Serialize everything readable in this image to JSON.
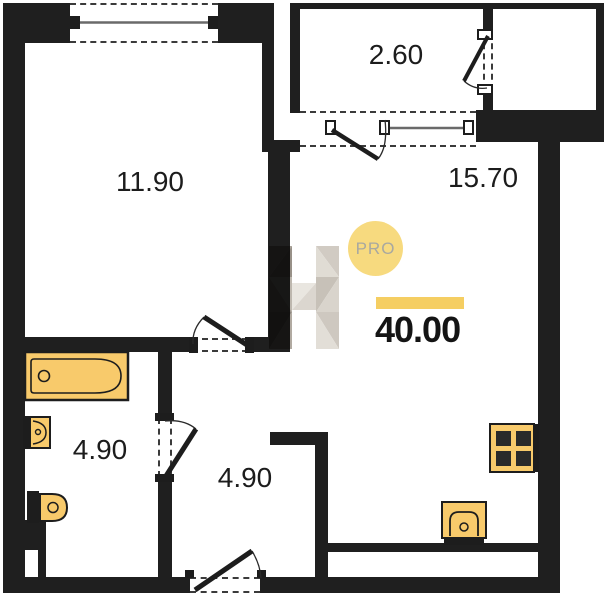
{
  "floorplan": {
    "badge_label": "PRO",
    "total_area": "40.00",
    "rooms": {
      "bedroom": {
        "area": "11.90"
      },
      "balcony": {
        "area": "2.60"
      },
      "living_kitchen": {
        "area": "15.70"
      },
      "bathroom": {
        "area": "4.90"
      },
      "hallway": {
        "area": "4.90"
      }
    },
    "fixtures": [
      "bathtub",
      "wash-basin",
      "toilet",
      "kitchen-sink",
      "stove"
    ],
    "colors": {
      "wall": "#1f1f1f",
      "fixture_fill": "#f8ca6b",
      "fixture_stroke": "#1d1d1d",
      "accent_bar": "#f5ce62",
      "badge_fill": "#f8da80",
      "badge_text": "#a8a8a0"
    }
  }
}
